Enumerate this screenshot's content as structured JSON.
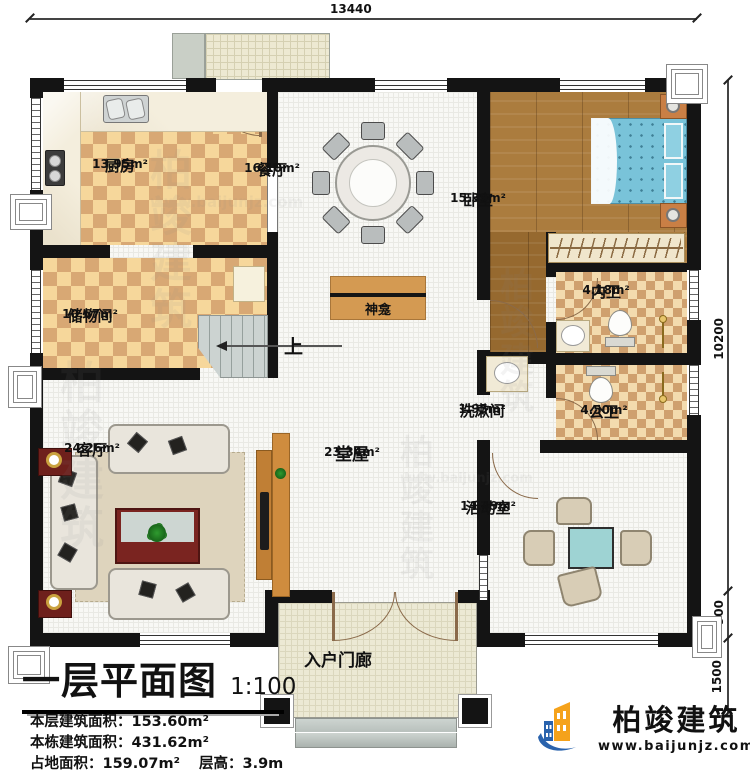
{
  "page": {
    "title": "一层平面图",
    "scale": "1:100"
  },
  "dimensions": {
    "top_width": "13440",
    "right_height": "10200",
    "right_lower": "900",
    "right_bottom": "1500"
  },
  "rooms": {
    "kitchen": {
      "name": "厨房",
      "area": "13.95m²"
    },
    "dining": {
      "name": "餐厅",
      "area": "16.10m²"
    },
    "bedroom": {
      "name": "卧室",
      "area": "15.39m²"
    },
    "storage": {
      "name": "储物间",
      "area": "10.67m²"
    },
    "living": {
      "name": "客厅",
      "area": "24.26m²"
    },
    "inner_bath": {
      "name": "内卫",
      "area": "4.18m²"
    },
    "washroom": {
      "name": "洗漱间",
      "area": "1.95m²"
    },
    "public_bath": {
      "name": "公卫",
      "area": "4.50m²"
    },
    "hall": {
      "name": "堂屋",
      "area": "23.34m²"
    },
    "activity": {
      "name": "活动室",
      "area": "14.49m²"
    },
    "porch": {
      "name": "入户门廊"
    }
  },
  "annotations": {
    "shrine": "神龛",
    "stairs_up": "上"
  },
  "info": {
    "rows": [
      {
        "label": "本层建筑面积：",
        "value": "153.60m²"
      },
      {
        "label": "本栋建筑面积：",
        "value": "431.62m²"
      },
      {
        "label": "占地面积：",
        "value": "159.07m²",
        "label2": "层高：",
        "value2": "3.9m"
      }
    ]
  },
  "brand": {
    "name": "柏竣建筑",
    "website": "www.baijunjz.com"
  },
  "colors": {
    "wall": "#141414",
    "checker_light": "#f6d79b",
    "checker_dark": "#d8a874",
    "wood": "#ab7c3e",
    "bed_teal": "#79c3d9",
    "brand_blue": "#2a63ad",
    "brand_orange": "#f5a21b"
  }
}
